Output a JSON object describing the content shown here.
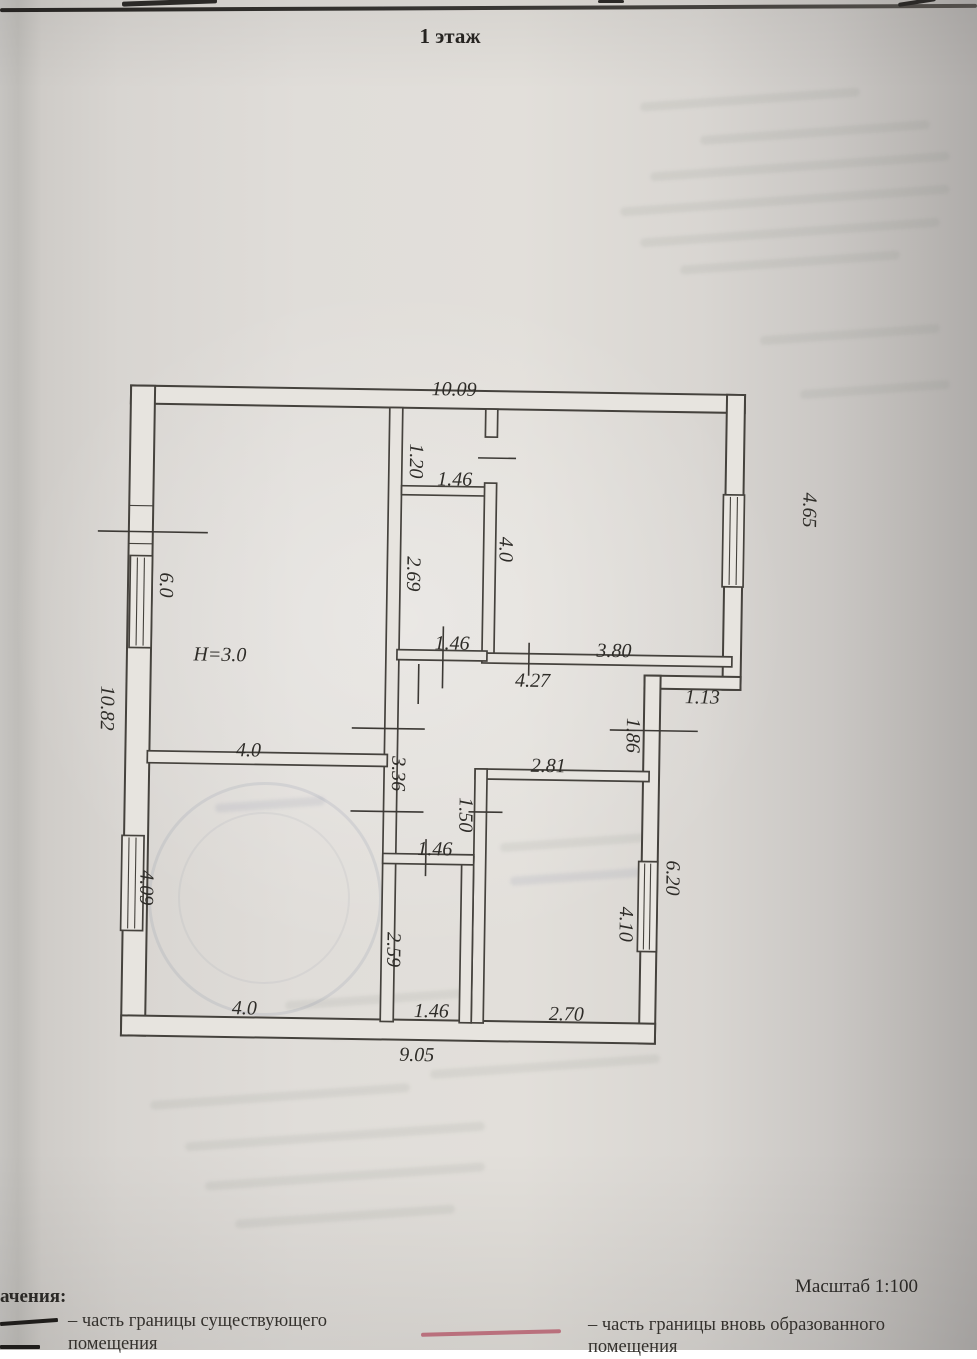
{
  "document": {
    "floor_title": "1 этаж",
    "scale_label": "Масштаб 1:100"
  },
  "legend": {
    "heading_cut": "ачения:",
    "existing_line1": "– часть границы существующего",
    "existing_line2": "помещения",
    "new_line1": "– часть границы вновь образованного",
    "new_line2": "помещения",
    "existing_color": "#1f1d1b",
    "new_color": "#b25567"
  },
  "floor_plan": {
    "height_note": "H=3.0",
    "dims": {
      "top_width": "10.09",
      "small_room_h": "1.20",
      "small_room_w": "1.46",
      "corridor_h": "2.69",
      "corridor_w": "1.46",
      "hall_w": "4.27",
      "tr_room_left": "4.0",
      "tr_room_bottom": "3.80",
      "tr_room_right": "4.65",
      "step_w": "1.13",
      "big_room_left": "6.0",
      "left_total": "10.82",
      "big_room_bottom": "4.0",
      "wall_336": "3.36",
      "br_room_top": "2.81",
      "right_186": "1.86",
      "left_150": "1.50",
      "bm_room_top": "1.46",
      "bl_room_left": "4.09",
      "bm_room_h": "2.59",
      "br_room_right": "4.10",
      "right_620": "6.20",
      "bl_room_bottom": "4.0",
      "bm_room_bottom": "1.46",
      "br_room_bottom": "2.70",
      "bottom_width": "9.05"
    }
  }
}
